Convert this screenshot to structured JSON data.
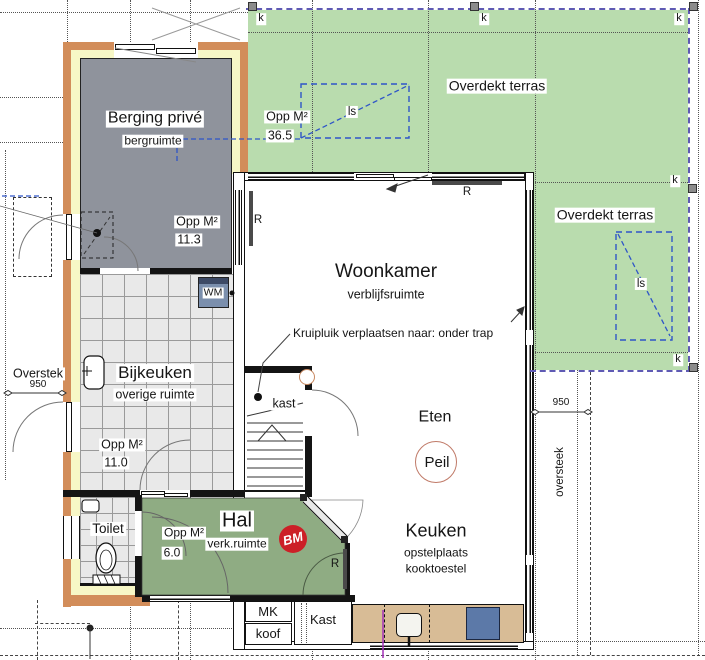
{
  "colors": {
    "terrace_green": "#b9dcae",
    "hal_green": "#8fac83",
    "berging_gray": "#8f939c",
    "wall_orange": "#d28d5a",
    "insulation_yellow": "#f7f7c6",
    "counter_tan": "#d8bc96",
    "cooktop_blue": "#5c79a8",
    "wm_blue": "#7b8fad",
    "dash_purple": "#5f5ab4",
    "dash_blue": "#2f55c8",
    "bm_red": "#cc2027",
    "peil_ring": "#c07a68"
  },
  "markers": {
    "column": "k",
    "skylight": "ls",
    "radiator": "R"
  },
  "terraces": {
    "top": {
      "name": "Overdekt terras",
      "area_label": "Opp M²",
      "area_value": "36.5"
    },
    "right": {
      "name": "Overdekt terras"
    }
  },
  "rooms": {
    "berging": {
      "name": "Berging privé",
      "subtype": "bergruimte",
      "area_label": "Opp M²",
      "area_value": "11.3"
    },
    "woonkamer": {
      "name": "Woonkamer",
      "subtype": "verblijfsruimte"
    },
    "bijkeuken": {
      "name": "Bijkeuken",
      "subtype": "overige ruimte",
      "area_label": "Opp M²",
      "area_value": "11.0"
    },
    "hal": {
      "name": "Hal",
      "subtype": "verk.ruimte",
      "area_label": "Opp M²",
      "area_value": "6.0"
    },
    "toilet": {
      "name": "Toilet"
    },
    "eten": {
      "name": "Eten"
    },
    "keuken": {
      "name": "Keuken",
      "subtype_line1": "opstelplaats",
      "subtype_line2": "kooktoestel"
    },
    "kast_stair": {
      "name": "kast"
    }
  },
  "fixtures": {
    "washing_machine": "WM",
    "meter_cupboard": "MK",
    "koof": "koof",
    "closet": "Kast"
  },
  "annotations": {
    "kruipluik": "Kruipluik verplaatsen naar: onder trap",
    "peil": "Peil",
    "bm": "BM",
    "overstek_left": {
      "label": "Overstek",
      "value": "950"
    },
    "overstek_right": {
      "label": "oversteek",
      "value": "950"
    }
  }
}
